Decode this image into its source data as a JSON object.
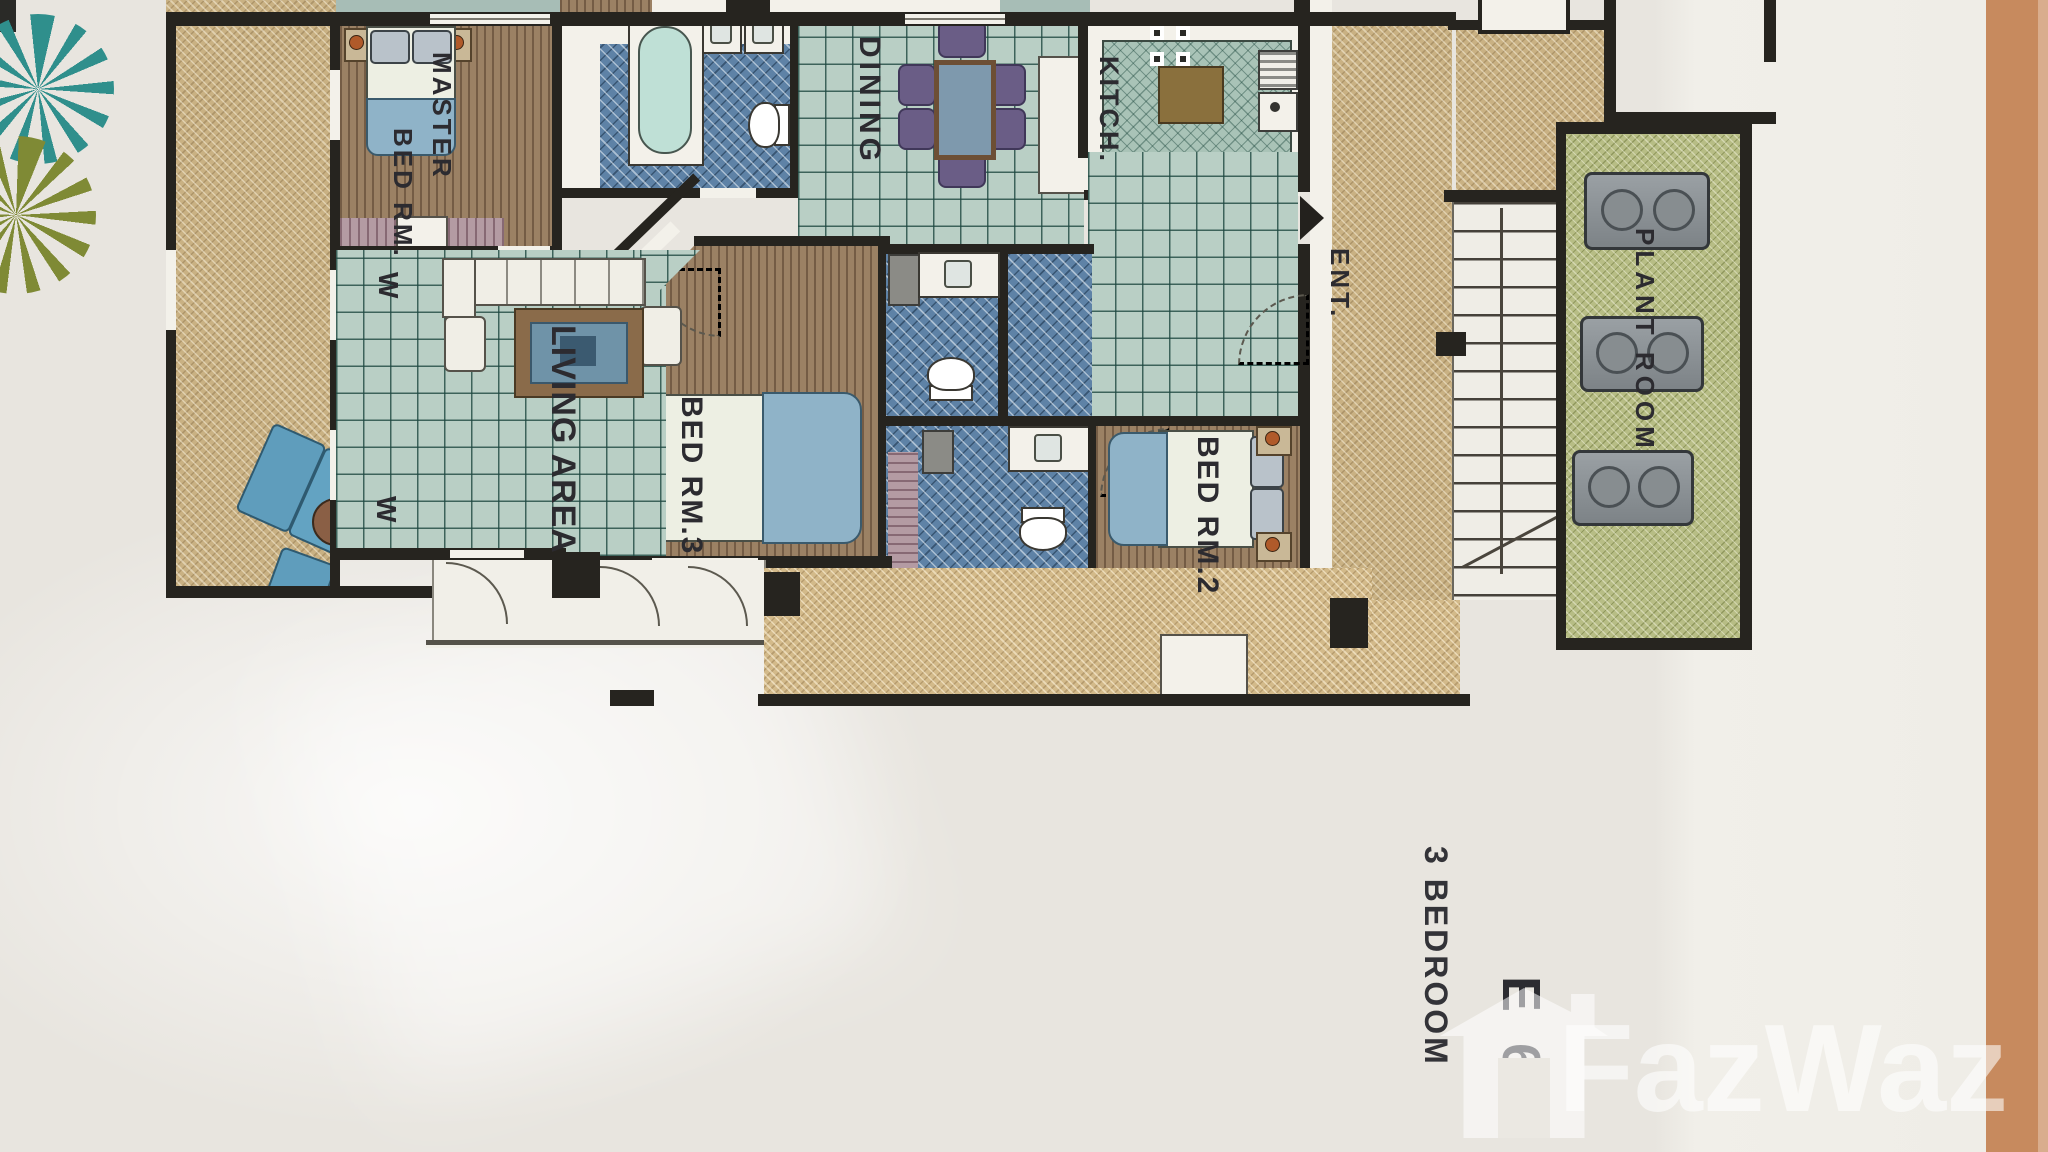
{
  "plan": {
    "rooms": {
      "master_bedroom": {
        "label_line1": "MASTER",
        "label_line2": "BED RM."
      },
      "dining": {
        "label": "DINING"
      },
      "kitchen": {
        "label": "KITCH."
      },
      "entrance": {
        "label": "ENT."
      },
      "plant_room": {
        "label": "PLANT ROOM"
      },
      "living_area": {
        "label": "LIVING AREA"
      },
      "bedroom3": {
        "label": "BED RM.3"
      },
      "bedroom2": {
        "label": "BED RM.2"
      }
    },
    "window_marks": {
      "mark": "W"
    },
    "unit": {
      "code": "E 6",
      "type": "3 BEDROOM"
    }
  },
  "watermark": {
    "brand": "FazWaz"
  },
  "colors": {
    "paper": "#e8e5df",
    "wall": "#26241f",
    "terrace_beige": "#c9b183",
    "tile_green": "#b9cfc5",
    "bath_blue": "#5e82a6",
    "bedroom_brown": "#9b8164",
    "plant_room_green": "#b7bd85",
    "side_stripe_orange": "#c78a5e",
    "watermark_white": "rgba(255,255,255,0.55)"
  }
}
